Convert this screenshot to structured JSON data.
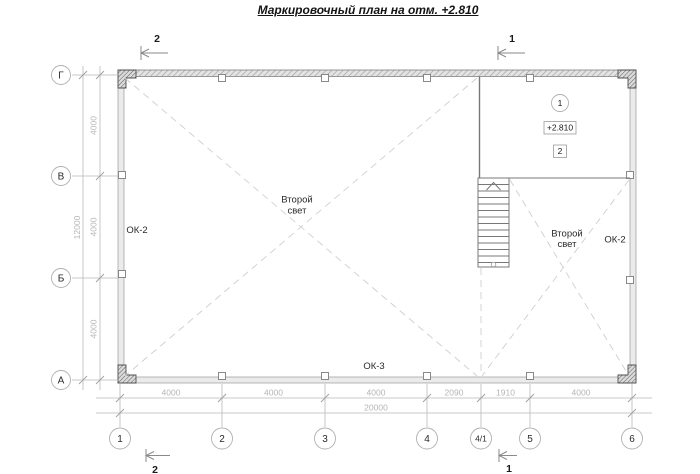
{
  "title": "Маркировочный план на отм. +2.810",
  "axes": {
    "rows": [
      {
        "label": "Г"
      },
      {
        "label": "В"
      },
      {
        "label": "Б"
      },
      {
        "label": "А"
      }
    ],
    "cols": [
      {
        "label": "1"
      },
      {
        "label": "2"
      },
      {
        "label": "3"
      },
      {
        "label": "4"
      },
      {
        "label": "4/1"
      },
      {
        "label": "5"
      },
      {
        "label": "6"
      }
    ]
  },
  "dimensions": {
    "bottom_segments": [
      "4000",
      "4000",
      "4000",
      "2090",
      "1910",
      "4000"
    ],
    "bottom_total": "20000",
    "left_segments": [
      "4000",
      "4000",
      "4000"
    ],
    "left_total": "12000"
  },
  "sections": {
    "top_left": "2",
    "top_right": "1",
    "bottom_left": "2",
    "bottom_right": "1"
  },
  "marks": {
    "window_left": "ОК-2",
    "window_right": "ОК-2",
    "window_bottom": "ОК-3",
    "second_light_line1": "Второй",
    "second_light_line2": "свет"
  },
  "room": {
    "axis_tag": "1",
    "elevation": "+2.810",
    "zone_tag": "2"
  },
  "colors": {
    "dim_gray": "#b5b5b5",
    "wall_stroke": "#9a9a9a",
    "dash_gray": "#cfcfcf",
    "text": "#1a1a1a"
  }
}
